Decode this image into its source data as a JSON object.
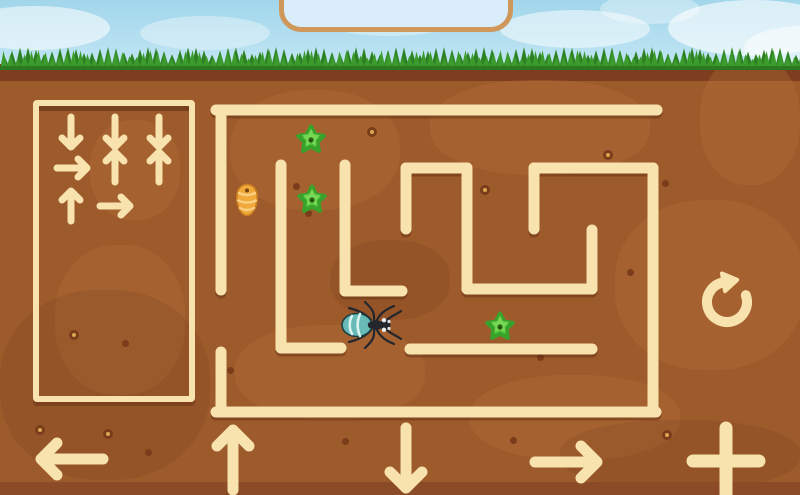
{
  "colors": {
    "cream": "#f8e2ae",
    "wall_shadow": "rgba(90,40,16,0.42)",
    "sky_top": "#a2d6eb",
    "sky_bottom": "#c2e6f4",
    "grass_front": "#3c9b2d",
    "grass_back": "#2e8123",
    "dirt": "#9d5a2b",
    "dirt_dark_band": "#7d3e1f",
    "dirt_bottom_strip": "#8b4b27",
    "sign_fill": "#d9eefa",
    "sign_border": "#d0975a",
    "star_fill": "#50c63b",
    "star_stroke": "#38a22a",
    "star_highlight": "#7edb59",
    "star_hole": "#2e6a14",
    "egg_fill": "#f2a93c",
    "egg_stripe": "#f9ce80",
    "egg_outline": "#c87c20",
    "ant_body": "#23272d",
    "ant_abdomen": "#68bab6",
    "ant_stripe": "#d9f3ef",
    "ant_eye": "#e9eef0"
  },
  "sign": {
    "x": 279,
    "y": -24,
    "w": 234,
    "h": 56,
    "r": 22
  },
  "command_panel": {
    "x": 33,
    "y": 100,
    "w": 162,
    "h": 302,
    "rows_summary": [
      [
        "down",
        "down",
        "down"
      ],
      [
        "right",
        "up",
        "up"
      ],
      [
        "up",
        "right"
      ]
    ],
    "commands": [
      {
        "dir": "down",
        "x": 71,
        "y": 132
      },
      {
        "dir": "down",
        "x": 115,
        "y": 132
      },
      {
        "dir": "down",
        "x": 159,
        "y": 132
      },
      {
        "dir": "right",
        "x": 72,
        "y": 168
      },
      {
        "dir": "up",
        "x": 115,
        "y": 167
      },
      {
        "dir": "up",
        "x": 159,
        "y": 167
      },
      {
        "dir": "up",
        "x": 71,
        "y": 206
      },
      {
        "dir": "right",
        "x": 115,
        "y": 206
      }
    ]
  },
  "maze": {
    "walls": [
      [
        216,
        110,
        657,
        110
      ],
      [
        221,
        110,
        221,
        290
      ],
      [
        221,
        352,
        221,
        412
      ],
      [
        216,
        412,
        656,
        412
      ],
      [
        653,
        168,
        653,
        412
      ],
      [
        534,
        168,
        653,
        168
      ],
      [
        534,
        168,
        534,
        229
      ],
      [
        406,
        168,
        467,
        168
      ],
      [
        406,
        168,
        406,
        229
      ],
      [
        467,
        168,
        467,
        289
      ],
      [
        467,
        289,
        592,
        289
      ],
      [
        592,
        230,
        592,
        289
      ],
      [
        281,
        165,
        281,
        348
      ],
      [
        281,
        348,
        341,
        348
      ],
      [
        345,
        165,
        345,
        291
      ],
      [
        345,
        291,
        402,
        291
      ],
      [
        410,
        349,
        592,
        349
      ]
    ],
    "stars": [
      {
        "x": 311,
        "y": 139
      },
      {
        "x": 312,
        "y": 199
      },
      {
        "x": 500,
        "y": 326
      }
    ],
    "egg": {
      "x": 247,
      "y": 200
    },
    "ant": {
      "x": 372,
      "y": 325,
      "facing": "right"
    }
  },
  "controls": {
    "buttons": [
      {
        "name": "move-left-button",
        "dir": "left",
        "x": 72,
        "y": 459,
        "len": 62,
        "head": 16
      },
      {
        "name": "move-up-button",
        "dir": "up",
        "x": 233,
        "y": 460,
        "len": 60,
        "head": 16
      },
      {
        "name": "move-down-button",
        "dir": "down",
        "x": 406,
        "y": 458,
        "len": 60,
        "head": 16
      },
      {
        "name": "move-right-button",
        "dir": "right",
        "x": 566,
        "y": 462,
        "len": 62,
        "head": 16
      }
    ],
    "add_button": {
      "x": 726,
      "y": 461,
      "arm": 33
    },
    "redo_button": {
      "x": 727,
      "y": 302,
      "radius": 20
    }
  },
  "decor": {
    "clouds": [
      {
        "x": -40,
        "y": 6,
        "w": 150,
        "h": 44,
        "o": 0.55
      },
      {
        "x": 140,
        "y": 16,
        "w": 130,
        "h": 34,
        "o": 0.35
      },
      {
        "x": 320,
        "y": 0,
        "w": 140,
        "h": 36,
        "o": 0.35
      },
      {
        "x": 500,
        "y": 10,
        "w": 150,
        "h": 38,
        "o": 0.5
      },
      {
        "x": 600,
        "y": -6,
        "w": 100,
        "h": 30,
        "o": 0.35
      },
      {
        "x": 668,
        "y": 0,
        "w": 170,
        "h": 56,
        "o": 0.6
      },
      {
        "x": 744,
        "y": 26,
        "w": 120,
        "h": 44,
        "o": 0.5
      }
    ],
    "patches_light": [
      [
        230,
        26,
        170,
        120
      ],
      [
        430,
        16,
        220,
        95
      ],
      [
        615,
        136,
        190,
        170
      ],
      [
        55,
        181,
        130,
        150
      ],
      [
        235,
        261,
        190,
        95
      ],
      [
        470,
        311,
        210,
        85
      ],
      [
        700,
        -9,
        100,
        130
      ],
      [
        90,
        56,
        90,
        100
      ]
    ],
    "patches_dark": [
      [
        0,
        226,
        210,
        190
      ],
      [
        560,
        356,
        240,
        70
      ],
      [
        330,
        176,
        120,
        80
      ]
    ],
    "spots": [
      {
        "x": 372,
        "y": 132,
        "t": "r"
      },
      {
        "x": 485,
        "y": 190,
        "t": "r"
      },
      {
        "x": 608,
        "y": 155,
        "t": "r"
      },
      {
        "x": 74,
        "y": 335,
        "t": "r"
      },
      {
        "x": 108,
        "y": 434,
        "t": "r"
      },
      {
        "x": 667,
        "y": 435,
        "t": "r"
      },
      {
        "x": 296,
        "y": 186,
        "t": "d"
      },
      {
        "x": 308,
        "y": 213,
        "t": "d"
      },
      {
        "x": 404,
        "y": 216,
        "t": "d"
      },
      {
        "x": 630,
        "y": 272,
        "t": "d"
      },
      {
        "x": 125,
        "y": 343,
        "t": "d"
      },
      {
        "x": 148,
        "y": 452,
        "t": "d"
      },
      {
        "x": 513,
        "y": 440,
        "t": "d"
      },
      {
        "x": 345,
        "y": 441,
        "t": "d"
      },
      {
        "x": 230,
        "y": 370,
        "t": "d"
      },
      {
        "x": 540,
        "y": 357,
        "t": "d"
      },
      {
        "x": 665,
        "y": 183,
        "t": "d"
      },
      {
        "x": 40,
        "y": 430,
        "t": "r"
      }
    ]
  }
}
